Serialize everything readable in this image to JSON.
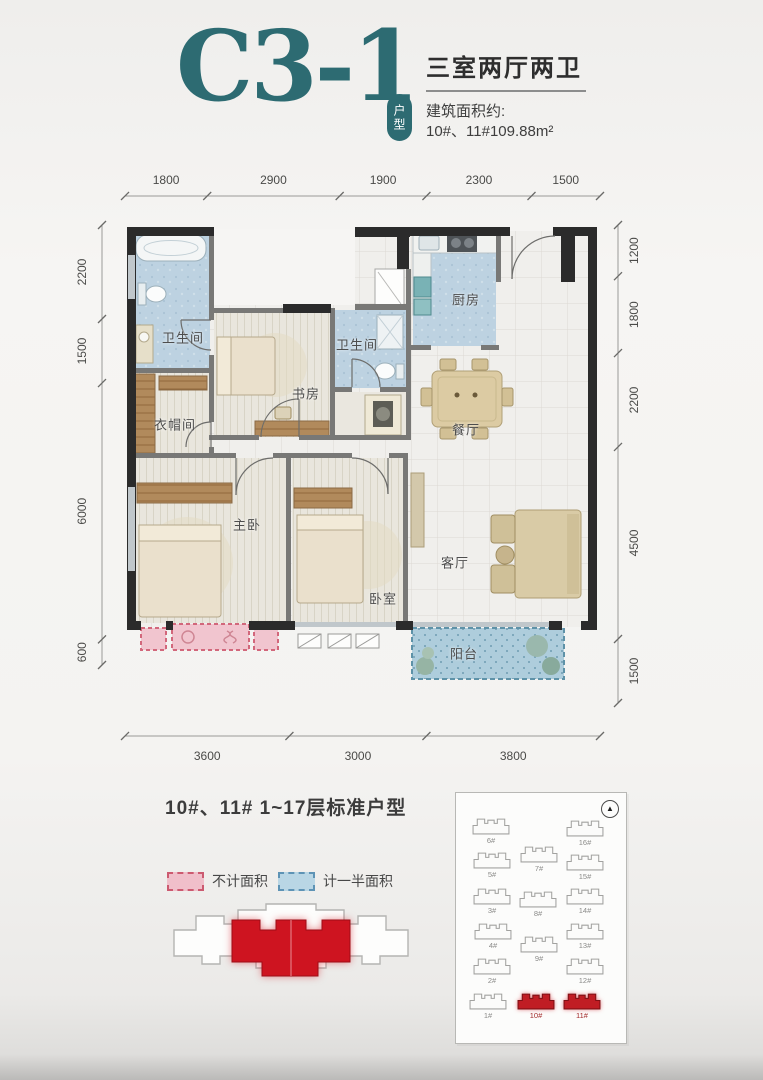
{
  "header": {
    "unit_code": "C3-1",
    "unit_badge": "户型",
    "layout_title": "三室两厅两卫",
    "area_label": "建筑面积约:",
    "area_value": "10#、11#109.88m²"
  },
  "floorplan": {
    "dims_top": [
      1800,
      2900,
      1900,
      2300,
      1500
    ],
    "dims_bottom": [
      3600,
      3000,
      3800
    ],
    "dims_left": [
      2200,
      1500,
      6000,
      600
    ],
    "dims_right": [
      1200,
      1800,
      2200,
      4500,
      1500
    ],
    "rooms": [
      {
        "name": "bathroom-master",
        "label": "卫生间",
        "x": 58,
        "y": 112
      },
      {
        "name": "cloakroom",
        "label": "衣帽间",
        "x": 50,
        "y": 199
      },
      {
        "name": "master-bedroom",
        "label": "主卧",
        "x": 122,
        "y": 299
      },
      {
        "name": "study",
        "label": "书房",
        "x": 181,
        "y": 168
      },
      {
        "name": "bathroom-2",
        "label": "卫生间",
        "x": 232,
        "y": 119
      },
      {
        "name": "kitchen",
        "label": "厨房",
        "x": 341,
        "y": 74
      },
      {
        "name": "dining-room",
        "label": "餐厅",
        "x": 341,
        "y": 204
      },
      {
        "name": "living-room",
        "label": "客厅",
        "x": 330,
        "y": 337
      },
      {
        "name": "bedroom-2",
        "label": "卧室",
        "x": 258,
        "y": 373
      },
      {
        "name": "balcony",
        "label": "阳台",
        "x": 339,
        "y": 428
      }
    ]
  },
  "caption": "10#、11# 1~17层标准户型",
  "legend": [
    {
      "name": "excluded-area",
      "label": "不计面积",
      "fill": "#f0bfca",
      "border": "#cc5a70"
    },
    {
      "name": "half-area",
      "label": "计一半面积",
      "fill": "#b9d6e5",
      "border": "#5e93b5"
    }
  ],
  "siteplan": {
    "north_symbol": "▲",
    "buildings": [
      {
        "label": "6#",
        "x": 13,
        "y": 24,
        "red": false
      },
      {
        "label": "16#",
        "x": 107,
        "y": 26,
        "red": false
      },
      {
        "label": "5#",
        "x": 14,
        "y": 58,
        "red": false
      },
      {
        "label": "7#",
        "x": 61,
        "y": 52,
        "red": false
      },
      {
        "label": "15#",
        "x": 107,
        "y": 60,
        "red": false
      },
      {
        "label": "3#",
        "x": 14,
        "y": 94,
        "red": false
      },
      {
        "label": "8#",
        "x": 60,
        "y": 97,
        "red": false
      },
      {
        "label": "14#",
        "x": 107,
        "y": 94,
        "red": false
      },
      {
        "label": "4#",
        "x": 15,
        "y": 129,
        "red": false
      },
      {
        "label": "9#",
        "x": 61,
        "y": 142,
        "red": false
      },
      {
        "label": "13#",
        "x": 107,
        "y": 129,
        "red": false
      },
      {
        "label": "2#",
        "x": 14,
        "y": 164,
        "red": false
      },
      {
        "label": "12#",
        "x": 107,
        "y": 164,
        "red": false
      },
      {
        "label": "1#",
        "x": 10,
        "y": 199,
        "red": false
      },
      {
        "label": "10#",
        "x": 58,
        "y": 199,
        "red": true
      },
      {
        "label": "11#",
        "x": 104,
        "y": 199,
        "red": true
      }
    ]
  },
  "colors": {
    "accent_teal": "#2d6b72",
    "highlight_red": "#ce1420",
    "excluded_pink": "#f0bfca",
    "half_area_blue": "#b9d6e5"
  }
}
